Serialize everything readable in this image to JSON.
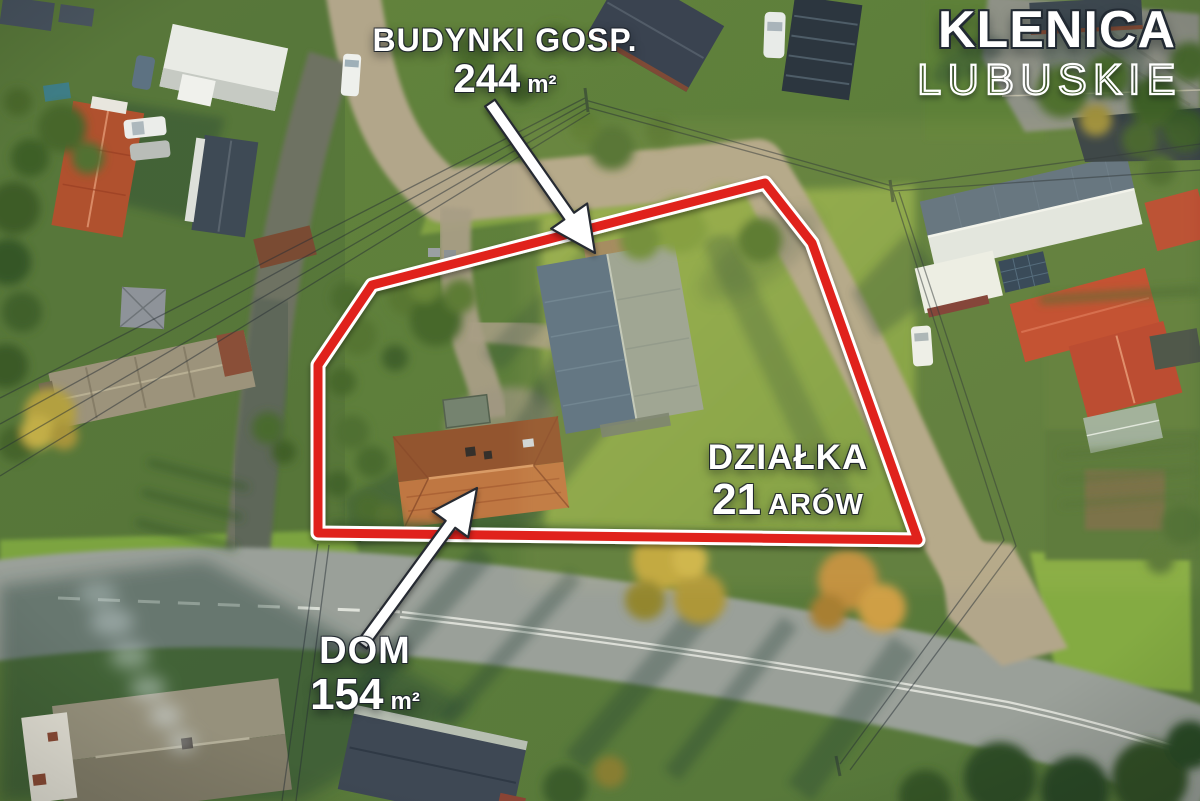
{
  "logo": {
    "title": "KLENICA",
    "subtitle": "LUBUSKIE"
  },
  "annotations": {
    "outbuildings": {
      "label": "BUDYNKI GOSP.",
      "value": "244",
      "unit": "m²"
    },
    "plot": {
      "label": "DZIAŁKA",
      "value": "21",
      "unit": "ARÓW"
    },
    "house": {
      "label": "DOM",
      "value": "154",
      "unit": "m²"
    }
  },
  "overlay": {
    "boundary_color": "#e0241c",
    "boundary_outline_color": "#ffffff",
    "arrow_color": "#ffffff",
    "arrow_outline_color": "#262b31",
    "label_color": "#ffffff"
  }
}
